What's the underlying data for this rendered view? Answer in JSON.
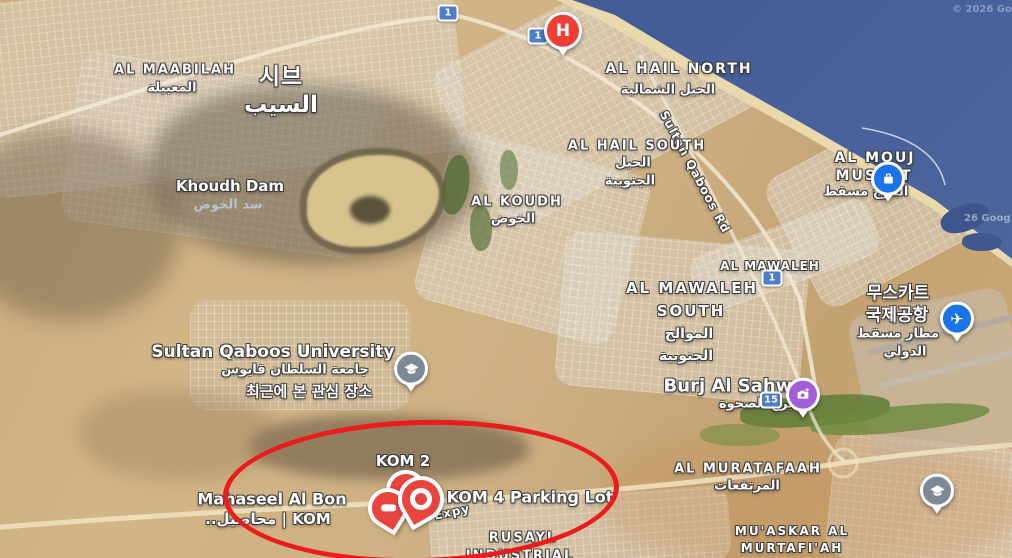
{
  "places": {
    "al_maabilah": {
      "en": "AL MAABILAH",
      "ar": "المعبيلة"
    },
    "seeb": {
      "ko": "시브",
      "ar": "السيب"
    },
    "khoudh_dam": {
      "en": "Khoudh Dam",
      "ar": "سد الخوض"
    },
    "al_koudh": {
      "en": "AL KOUDH",
      "ar": "الخوض"
    },
    "al_hail_north": {
      "en": "AL HAIL NORTH",
      "ar": "الحيل الشمالية"
    },
    "al_hail_south": {
      "en": "AL HAIL SOUTH",
      "ar1": "الحيل",
      "ar2": "الجنوبية"
    },
    "al_mouj": {
      "en1": "AL MOUJ",
      "en2": "MUSCAT",
      "ar": "الموج مسقط"
    },
    "al_mawaleh": {
      "en": "AL MAWALEH"
    },
    "al_mawaleh_south": {
      "en1": "AL MAWALEH",
      "en2": "SOUTH",
      "ar1": "الموالح",
      "ar2": "الجنوبية"
    },
    "muscat_airport": {
      "ko1": "무스카트",
      "ko2": "국제공항",
      "ar1": "مطار مسقط",
      "ar2": "الدولي"
    },
    "squ": {
      "en": "Sultan Qaboos University",
      "ar": "جامعة السلطان قابوس",
      "ko": "최근에 본 관심 장소"
    },
    "burj_al_sahwa": {
      "en": "Burj Al Sahwa",
      "ar": "برج الصحوة"
    },
    "al_muratafaah": {
      "en": "AL MURATAFAAH",
      "ar": "المرتفعات"
    },
    "muaskar": {
      "en1": "MU'ASKAR AL",
      "en2": "MURTAFI'AH"
    },
    "rusayl": {
      "en1": "RUSAYL",
      "en2": "INDUSTRIAL"
    },
    "kom2": {
      "en": "KOM 2"
    },
    "kom4": {
      "en": "KOM 4 Parking Lot"
    },
    "mahaseel": {
      "en": "Mahaseel Al Bon",
      "ar": "..محاصيل | KOM"
    }
  },
  "road_labels": {
    "sultan_qaboos_rd": "Sultan Qaboos Rd",
    "expy": "Expy"
  },
  "shields": {
    "route_1": "1",
    "route_15": "15"
  },
  "markers": {
    "hospital_letter": "H"
  },
  "attribution": {
    "top_right": "© 2026 Go",
    "coast": "26 Goog"
  },
  "annotation": {
    "color": "#ea1c1c"
  }
}
